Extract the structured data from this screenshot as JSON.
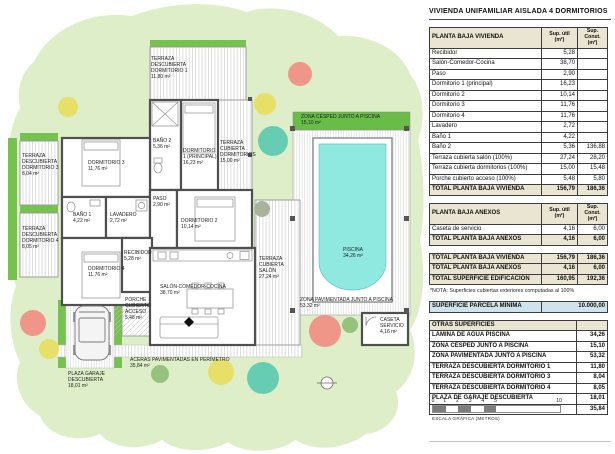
{
  "title": "VIVIENDA UNIFAMILIAR AISLADA 4 DORMITORIOS",
  "tables": {
    "col_util": "Sup. útil\n(m²)",
    "col_const": "Sup. Const.\n(m²)",
    "vivienda": {
      "header": "PLANTA BAJA VIVIENDA",
      "rows": [
        {
          "label": "Recibidor",
          "util": "5,28",
          "const": ""
        },
        {
          "label": "Salón-Comedor-Cocina",
          "util": "38,70",
          "const": ""
        },
        {
          "label": "Paso",
          "util": "2,90",
          "const": ""
        },
        {
          "label": "Dormitorio 1 (principal)",
          "util": "16,23",
          "const": ""
        },
        {
          "label": "Dormitorio 2",
          "util": "10,14",
          "const": ""
        },
        {
          "label": "Dormitorio 3",
          "util": "11,76",
          "const": ""
        },
        {
          "label": "Dormitorio 4",
          "util": "11,76",
          "const": ""
        },
        {
          "label": "Lavadero",
          "util": "2,72",
          "const": ""
        },
        {
          "label": "Baño 1",
          "util": "4,22",
          "const": ""
        },
        {
          "label": "Baño 2",
          "util": "5,36",
          "const": "136,88"
        },
        {
          "label": "Terraza cubierta salón (100%)",
          "util": "27,24",
          "const": "28,20"
        },
        {
          "label": "Terraza cubierta dormitorios (100%)",
          "util": "15,00",
          "const": "15,48"
        },
        {
          "label": "Porche cubierto acceso (100%)",
          "util": "5,48",
          "const": "5,80"
        }
      ],
      "total": {
        "label": "TOTAL PLANTA BAJA VIVIENDA",
        "util": "156,79",
        "const": "186,36"
      }
    },
    "anexos": {
      "header": "PLANTA BAJA ANEXOS",
      "rows": [
        {
          "label": "Caseta de servicio",
          "util": "4,16",
          "const": "6,00"
        }
      ],
      "total": {
        "label": "TOTAL PLANTA BAJA ANEXOS",
        "util": "4,16",
        "const": "6,00"
      }
    },
    "resumen": {
      "rows": [
        {
          "label": "TOTAL PLANTA BAJA VIVIENDA",
          "util": "156,79",
          "const": "186,36"
        },
        {
          "label": "TOTAL PLANTA BAJA ANEXOS",
          "util": "4,16",
          "const": "6,00"
        },
        {
          "label": "TOTAL SUPERFICIE EDIFICACIÓN",
          "util": "160,95",
          "const": "192,36"
        }
      ]
    },
    "nota": "*NOTA: Superficies cubiertas exteriores computadas al 100%",
    "parcela": {
      "label": "SUPERFICIE PARCELA MÍNIMA",
      "value": "10.000,00"
    },
    "otras": {
      "header": "OTRAS SUPERFICIES",
      "rows": [
        {
          "label": "LÁMINA DE AGUA PISCINA",
          "value": "34,26"
        },
        {
          "label": "ZONA CÉSPED JUNTO A PISCINA",
          "value": "15,10"
        },
        {
          "label": "ZONA PAVIMENTADA JUNTO A PISCINA",
          "value": "53,32"
        },
        {
          "label": "TERRAZA DESCUBIERTA DORMITORIO 1",
          "value": "11,80"
        },
        {
          "label": "TERRAZA DESCUBIERTA DORMITORIO 3",
          "value": "8,04"
        },
        {
          "label": "TERRAZA DESCUBIERTA DORMITORIO 4",
          "value": "8,05"
        },
        {
          "label": "PLAZA DE GARAJE DESCUBIERTA",
          "value": "18,01"
        },
        {
          "label": "ACERAS PAVIMENTADAS EN PERÍMETRO",
          "value": "35,84"
        }
      ]
    }
  },
  "scale": {
    "ticks": [
      "0",
      "1",
      "2",
      "3",
      "4",
      "5",
      "10"
    ],
    "caption": "ESCALA GRÁFICA (METROS)"
  },
  "plan": {
    "labels": {
      "terr_d1": "TERRAZA\nDESCUBIERTA\nDORMITORIO 1\n11,80 m²",
      "bano2": "BAÑO 2\n5,36 m²",
      "dorm1": "DORMITORIO\n1 (PRINCIPAL)\n16,23 m²",
      "terr_cub_dorm": "TERRAZA\nCUBIERTA\nDORMITORIOS\n15,00 m²",
      "cesped": "ZONA CÉSPED JUNTO A PISCINA\n15,10 m²",
      "terr_d3": "TERRAZA\nDESCUBIERTA\nDORMITORIO 3\n8,04 m²",
      "dorm3": "DORMITORIO 3\n11,76 m²",
      "bano1": "BAÑO 1\n4,22 m²",
      "lavadero": "LAVADERO\n2,72 m²",
      "paso": "PASO\n2,90 m²",
      "dorm2": "DORMITORIO 2\n10,14 m²",
      "terr_d4": "TERRAZA\nDESCUBIERTA\nDORMITORIO 4\n8,05 m²",
      "dorm4": "DORMITORIO 4\n11,76 m²",
      "recibidor": "RECIBIDOR\n5,28 m²",
      "porche": "PORCHE\nCUBIERTO\nACCESO\n5,48 m²",
      "salon": "SALÓN-COMEDOR-COCINA\n38,70 m²",
      "terr_cub_salon": "TERRAZA\nCUBIERTA\nSALÓN\n27,24 m²",
      "piscina": "PISCINA\n34,26 m²",
      "zona_pav": "ZONA PAVIMENTADA JUNTO A PISCINA\n53,32 m²",
      "caseta": "CASETA\nSERVICIO\n4,16 m²",
      "garaje": "PLAZA GARAJE\nDESCUBIERTA\n18,01 m²",
      "aceras": "ACERAS PAVIMENTADAS EN PERÍMETRO\n35,84 m²"
    }
  },
  "colors": {
    "parcel": "#ddeec8",
    "accent_green": "#76c24f",
    "cesped_green": "#68bc47",
    "pool_water": "#8fe9e0",
    "wall": "#4f4f4f",
    "table_beige": "#e9e5d2",
    "table_blue": "#cfe3ef",
    "tree_salmon": "#ef9688",
    "tree_yellow": "#e6e069",
    "tree_teal": "#66cdb3",
    "tree_green": "#95c27d",
    "tree_gray": "#a8b49a"
  }
}
